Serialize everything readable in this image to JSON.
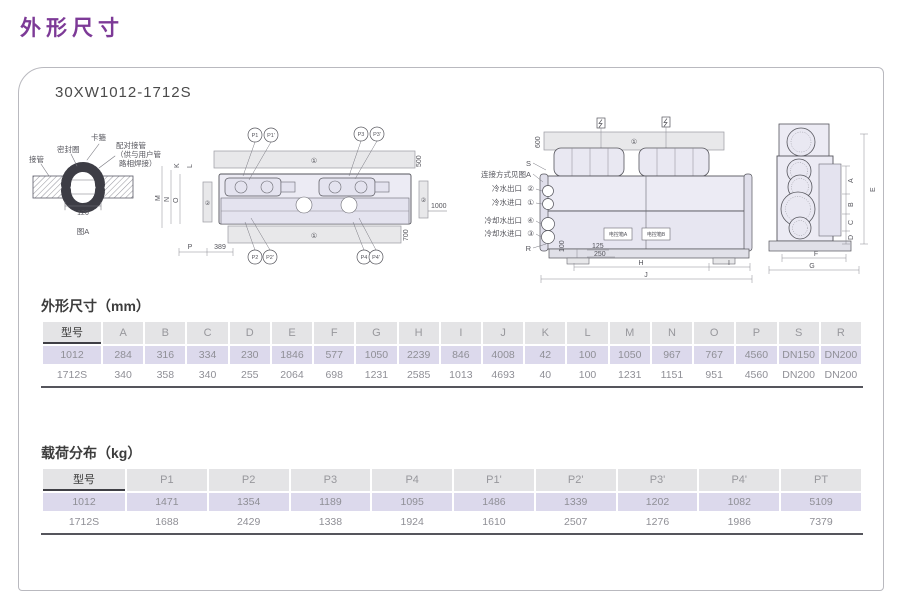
{
  "page": {
    "title": "外形尺寸",
    "model": "30XW1012-1712S"
  },
  "colors": {
    "accent": "#7d3a97",
    "header_bg": "#e4e4e6",
    "row_alt_bg": "#dcd9ec",
    "table_rule": "#55555c"
  },
  "drawing": {
    "detail": {
      "pipe": "接管",
      "seal": "密封圈",
      "clamp": "卡箍",
      "mating1": "配对接管",
      "mating2": "（供与用户管",
      "mating3": "路相焊接）",
      "dim120": "120",
      "caption": "图A"
    },
    "top_view": {
      "rail": "①",
      "pad": "②",
      "dim500": "500",
      "dim700": "700",
      "dim1000": "1000",
      "dim389": "389",
      "dimP": "P",
      "dimK": "K",
      "dimL": "L",
      "dimM": "M",
      "dimN": "N",
      "dimO": "O",
      "p1": "P1",
      "p1p": "P1'",
      "p2": "P2",
      "p2p": "P2'",
      "p3": "P3",
      "p3p": "P3'",
      "p4": "P4",
      "p4p": "P4'"
    },
    "side_view": {
      "rail": "①",
      "dim600": "600",
      "labelS": "S",
      "connect": "连接方式见图A",
      "port1": "冷水出口",
      "port1n": "②",
      "port2": "冷水进口",
      "port2n": "①",
      "port3": "冷却水出口",
      "port3n": "④",
      "port4": "冷却水进口",
      "port4n": "③",
      "labelR": "R",
      "dim100": "100",
      "dim125": "125",
      "dim250": "250",
      "dimH": "H",
      "dimI": "I",
      "dimJ": "J",
      "boxA": "电控箱A",
      "boxB": "电控箱B"
    },
    "end_view": {
      "dimA": "A",
      "dimB": "B",
      "dimC": "C",
      "dimD": "D",
      "dimE": "E",
      "dimF": "F",
      "dimG": "G"
    }
  },
  "dim_table": {
    "title": "外形尺寸（mm）",
    "columns": [
      "型号",
      "A",
      "B",
      "C",
      "D",
      "E",
      "F",
      "G",
      "H",
      "I",
      "J",
      "K",
      "L",
      "M",
      "N",
      "O",
      "P",
      "S",
      "R"
    ],
    "rows": [
      [
        "1012",
        "284",
        "316",
        "334",
        "230",
        "1846",
        "577",
        "1050",
        "2239",
        "846",
        "4008",
        "42",
        "100",
        "1050",
        "967",
        "767",
        "4560",
        "DN150",
        "DN200"
      ],
      [
        "1712S",
        "340",
        "358",
        "340",
        "255",
        "2064",
        "698",
        "1231",
        "2585",
        "1013",
        "4693",
        "40",
        "100",
        "1231",
        "1151",
        "951",
        "4560",
        "DN200",
        "DN200"
      ]
    ]
  },
  "load_table": {
    "title": "载荷分布（kg）",
    "columns": [
      "型号",
      "P1",
      "P2",
      "P3",
      "P4",
      "P1'",
      "P2'",
      "P3'",
      "P4'",
      "PT"
    ],
    "rows": [
      [
        "1012",
        "1471",
        "1354",
        "1189",
        "1095",
        "1486",
        "1339",
        "1202",
        "1082",
        "5109"
      ],
      [
        "1712S",
        "1688",
        "2429",
        "1338",
        "1924",
        "1610",
        "2507",
        "1276",
        "1986",
        "7379"
      ]
    ]
  }
}
